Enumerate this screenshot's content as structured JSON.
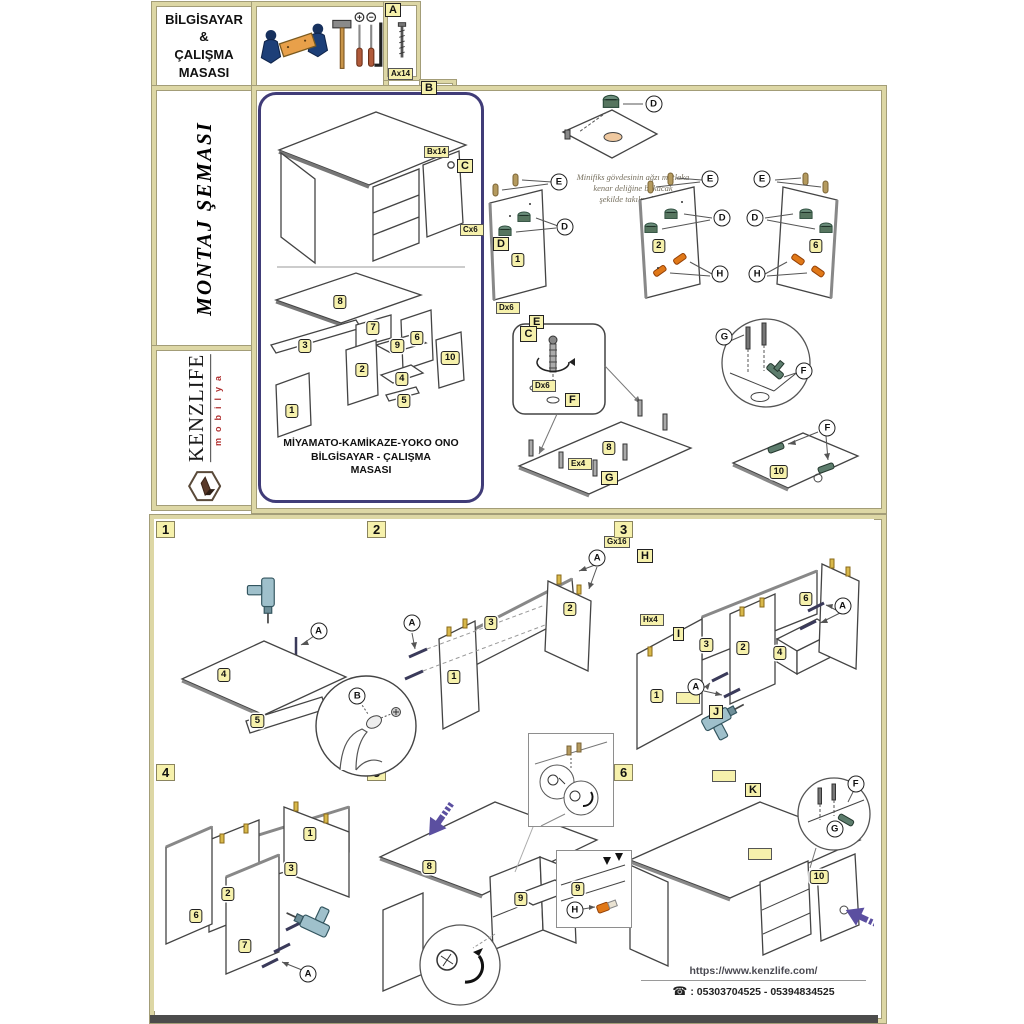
{
  "title_block": {
    "lines": "BİLGİSAYAR\n&\nÇALIŞMA\nMASASI"
  },
  "montaj": {
    "label": "MONTAJ ŞEMASI"
  },
  "brand": {
    "name": "KENZLIFE",
    "sub": "mobilya"
  },
  "hardware": {
    "items": [
      {
        "letter": "A",
        "qty": "Ax14",
        "icon": "confirmat-screw-icon"
      },
      {
        "letter": "B",
        "qty": "Bx14",
        "icon": "cover-cap-icon"
      },
      {
        "letter": "C",
        "qty": "Cx6",
        "icon": "cam-bolt-icon"
      },
      {
        "letter": "D",
        "qty": "Dx6",
        "icon": "minifix-cam-icon"
      },
      {
        "letter": "E",
        "qty": "Dx6",
        "icon": "wood-dowel-icon"
      },
      {
        "letter": "F",
        "qty": "Ex4",
        "icon": "hinge-icon"
      },
      {
        "letter": "G",
        "qty": "Gx16",
        "icon": "screw-icon"
      },
      {
        "letter": "H",
        "qty": "Hx4",
        "icon": "orange-cap-icon"
      },
      {
        "letter": "I",
        "qty": "",
        "icon": ""
      },
      {
        "letter": "J",
        "qty": "",
        "icon": ""
      },
      {
        "letter": "K",
        "qty": "",
        "icon": ""
      }
    ]
  },
  "overview": {
    "product_name": "MİYAMATO-KAMİKAZE-YOKO ONO\nBİLGİSAYAR - ÇALIŞMA\nMASASI",
    "note": "Minifiks gövdesinin ağzı mutlaka\nkenar deliğine bakacak\nşekilde takılmalıdır."
  },
  "steps": [
    {
      "num": "1"
    },
    {
      "num": "2"
    },
    {
      "num": "3"
    },
    {
      "num": "4"
    },
    {
      "num": "5"
    },
    {
      "num": "6"
    }
  ],
  "footer": {
    "website": "https://www.kenzlife.com/",
    "phone": ": 05303704525 - 05394834525"
  },
  "colors": {
    "cream_border": "#ddd7a5",
    "label_yellow": "#f6f1ac",
    "overview_navy": "#403c78",
    "arrow_purple": "#5b4fa0",
    "cap_orange": "#e07818",
    "brand_red": "#b03030"
  },
  "badges": {
    "overview": [
      {
        "t": "8",
        "x": 36,
        "y": 51,
        "k": "part"
      },
      {
        "t": "7",
        "x": 51,
        "y": 57.5,
        "k": "part"
      },
      {
        "t": "6",
        "x": 71,
        "y": 60,
        "k": "part"
      },
      {
        "t": "3",
        "x": 20,
        "y": 62,
        "k": "part"
      },
      {
        "t": "9",
        "x": 62,
        "y": 62,
        "k": "part"
      },
      {
        "t": "2",
        "x": 46,
        "y": 68,
        "k": "part"
      },
      {
        "t": "10",
        "x": 86,
        "y": 65,
        "k": "part"
      },
      {
        "t": "4",
        "x": 64,
        "y": 70,
        "k": "part"
      },
      {
        "t": "5",
        "x": 65,
        "y": 75.5,
        "k": "part"
      },
      {
        "t": "1",
        "x": 14,
        "y": 78,
        "k": "part"
      }
    ],
    "detailD": [
      {
        "t": "D",
        "x": 88,
        "y": 16,
        "k": "circ"
      }
    ],
    "panel1": [
      {
        "t": "E",
        "x": 84,
        "y": 10,
        "k": "circ"
      },
      {
        "t": "D",
        "x": 90,
        "y": 42,
        "k": "circ"
      },
      {
        "t": "1",
        "x": 40,
        "y": 66,
        "k": "part"
      }
    ],
    "panel2": [
      {
        "t": "E",
        "x": 82,
        "y": 8,
        "k": "circ"
      },
      {
        "t": "D",
        "x": 92,
        "y": 36,
        "k": "circ"
      },
      {
        "t": "2",
        "x": 40,
        "y": 56,
        "k": "part"
      },
      {
        "t": "H",
        "x": 90,
        "y": 76,
        "k": "circ"
      }
    ],
    "panel6": [
      {
        "t": "E",
        "x": 14,
        "y": 8,
        "k": "circ"
      },
      {
        "t": "D",
        "x": 8,
        "y": 36,
        "k": "circ"
      },
      {
        "t": "6",
        "x": 58,
        "y": 56,
        "k": "part"
      },
      {
        "t": "H",
        "x": 10,
        "y": 76,
        "k": "circ"
      }
    ],
    "part8fig": [
      {
        "t": "C",
        "x": 12,
        "y": 9,
        "k": "sq"
      },
      {
        "t": "8",
        "x": 53,
        "y": 72,
        "k": "part"
      }
    ],
    "gffig": [
      {
        "t": "G",
        "x": 12,
        "y": 22,
        "k": "circ"
      },
      {
        "t": "F",
        "x": 88,
        "y": 55,
        "k": "circ"
      }
    ],
    "part10fig": [
      {
        "t": "F",
        "x": 72,
        "y": 12,
        "k": "circ"
      },
      {
        "t": "10",
        "x": 40,
        "y": 66,
        "k": "part"
      }
    ],
    "step1": [
      {
        "t": "A",
        "x": 78,
        "y": 46,
        "k": "circ"
      },
      {
        "t": "4",
        "x": 33,
        "y": 64,
        "k": "part"
      },
      {
        "t": "5",
        "x": 49,
        "y": 83,
        "k": "part"
      }
    ],
    "bcircle": [
      {
        "t": "B",
        "x": 42,
        "y": 22,
        "k": "circ"
      }
    ],
    "step2": [
      {
        "t": "A",
        "x": 19,
        "y": 43,
        "k": "circ"
      },
      {
        "t": "A",
        "x": 94,
        "y": 16,
        "k": "circ"
      },
      {
        "t": "3",
        "x": 51,
        "y": 43,
        "k": "part"
      },
      {
        "t": "2",
        "x": 83,
        "y": 37,
        "k": "part"
      },
      {
        "t": "1",
        "x": 36,
        "y": 65,
        "k": "part"
      }
    ],
    "step3": [
      {
        "t": "6",
        "x": 74,
        "y": 33,
        "k": "part"
      },
      {
        "t": "A",
        "x": 88,
        "y": 36,
        "k": "circ"
      },
      {
        "t": "3",
        "x": 36,
        "y": 52,
        "k": "part"
      },
      {
        "t": "2",
        "x": 50,
        "y": 53,
        "k": "part"
      },
      {
        "t": "4",
        "x": 64,
        "y": 55,
        "k": "part"
      },
      {
        "t": "A",
        "x": 32,
        "y": 69,
        "k": "circ"
      },
      {
        "t": "1",
        "x": 17,
        "y": 73,
        "k": "part"
      }
    ],
    "step4": [
      {
        "t": "1",
        "x": 74,
        "y": 29,
        "k": "part"
      },
      {
        "t": "3",
        "x": 65,
        "y": 43,
        "k": "part"
      },
      {
        "t": "2",
        "x": 35,
        "y": 53,
        "k": "part"
      },
      {
        "t": "6",
        "x": 20,
        "y": 62,
        "k": "part"
      },
      {
        "t": "7",
        "x": 43,
        "y": 74,
        "k": "part"
      },
      {
        "t": "A",
        "x": 73,
        "y": 85,
        "k": "circ"
      }
    ],
    "step5": [
      {
        "t": "8",
        "x": 26,
        "y": 42,
        "k": "part"
      },
      {
        "t": "9",
        "x": 63,
        "y": 55,
        "k": "part"
      }
    ],
    "step5box": [
      {
        "t": "9",
        "x": 28,
        "y": 50,
        "k": "part"
      },
      {
        "t": "H",
        "x": 24,
        "y": 78,
        "k": "circ"
      }
    ],
    "step6": [
      {
        "t": "F",
        "x": 93,
        "y": 9,
        "k": "circ"
      },
      {
        "t": "G",
        "x": 85,
        "y": 27,
        "k": "circ"
      },
      {
        "t": "10",
        "x": 79,
        "y": 46,
        "k": "part"
      }
    ]
  }
}
